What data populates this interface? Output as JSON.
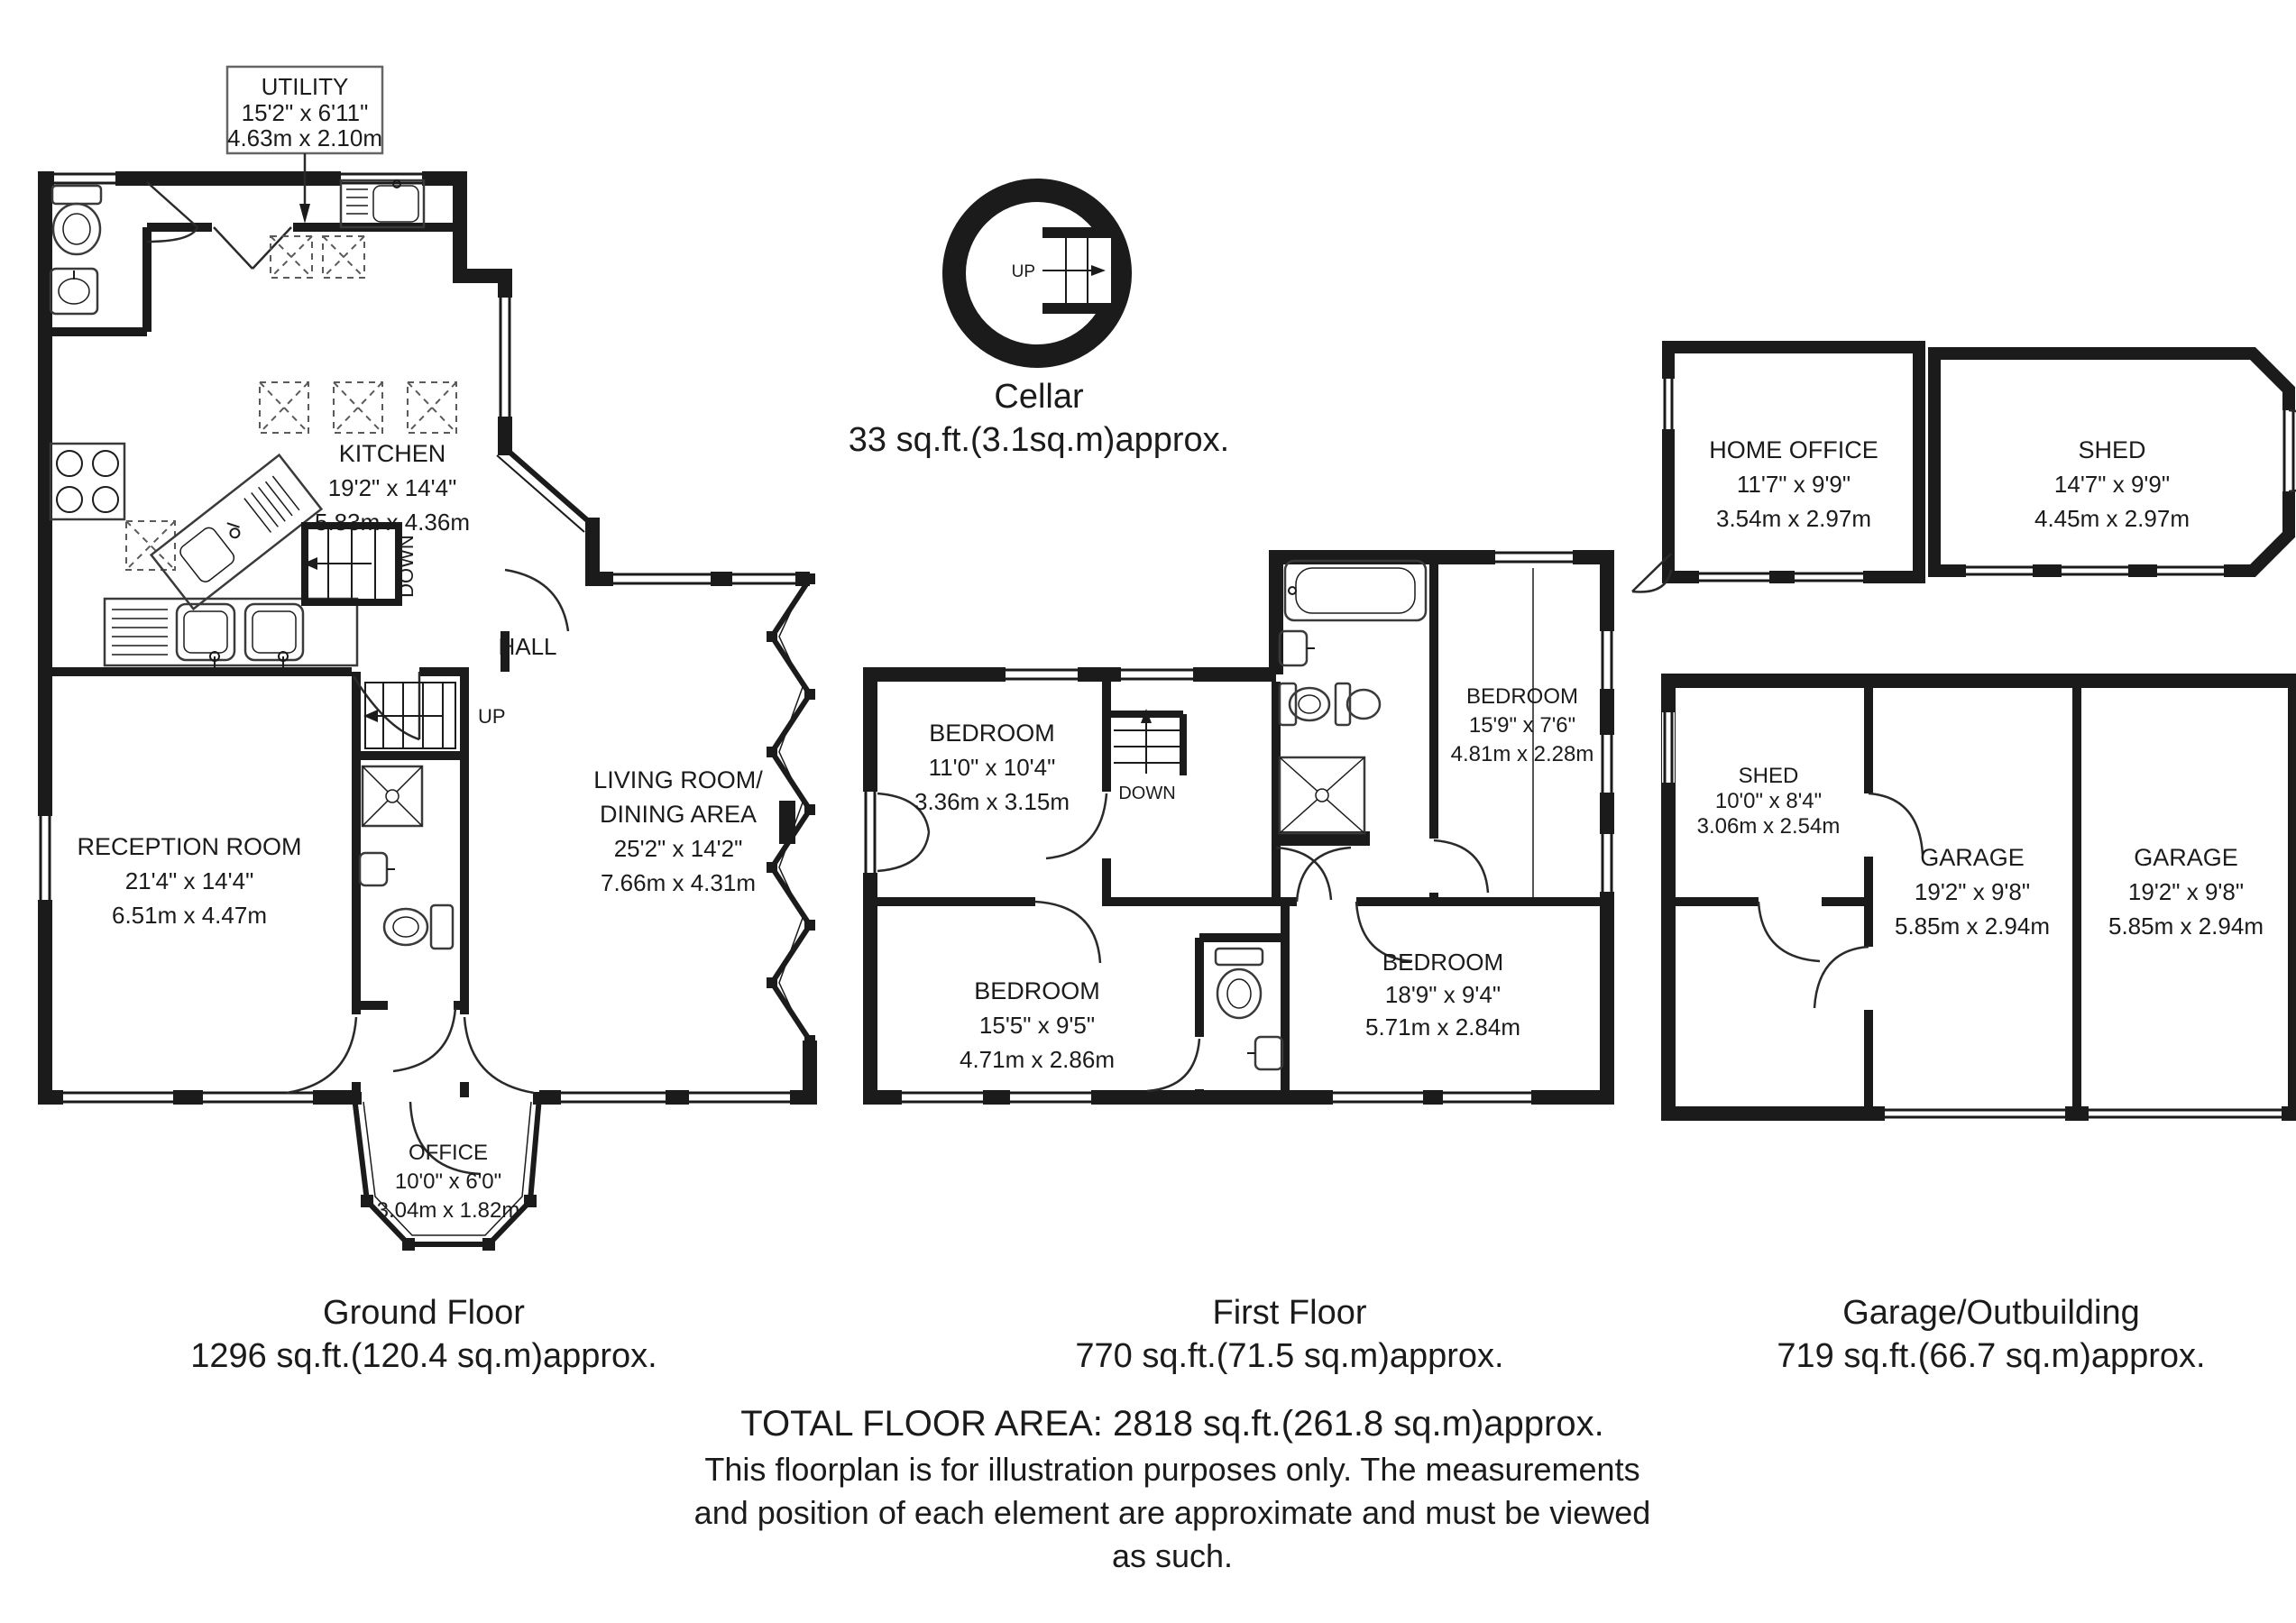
{
  "palette": {
    "ink": "#1b1b1b",
    "bg": "#ffffff"
  },
  "ground_floor": {
    "title": "Ground Floor",
    "area": "1296 sq.ft.(120.4 sq.m)approx.",
    "utility": {
      "name": "UTILITY",
      "imperial": "15'2\" x 6'11\"",
      "metric": "4.63m x 2.10m"
    },
    "kitchen": {
      "name": "KITCHEN",
      "imperial": "19'2\" x 14'4\"",
      "metric": "5.83m x 4.36m"
    },
    "hall": {
      "name": "HALL"
    },
    "living_room": {
      "name1": "LIVING ROOM/",
      "name2": "DINING AREA",
      "imperial": "25'2\" x 14'2\"",
      "metric": "7.66m x 4.31m"
    },
    "reception": {
      "name": "RECEPTION ROOM",
      "imperial": "21'4\" x 14'4\"",
      "metric": "6.51m x 4.47m"
    },
    "office": {
      "name": "OFFICE",
      "imperial": "10'0\" x 6'0\"",
      "metric": "3.04m x 1.82m"
    },
    "stair_up": "UP",
    "stair_down": "DOWN"
  },
  "cellar": {
    "title": "Cellar",
    "area": "33 sq.ft.(3.1sq.m)approx.",
    "stair_up": "UP"
  },
  "first_floor": {
    "title": "First Floor",
    "area": "770 sq.ft.(71.5 sq.m)approx.",
    "bedroom_nw": {
      "name": "BEDROOM",
      "imperial": "11'0\" x 10'4\"",
      "metric": "3.36m x 3.15m"
    },
    "bedroom_ne": {
      "name": "BEDROOM",
      "imperial": "15'9\" x 7'6\"",
      "metric": "4.81m x 2.28m"
    },
    "bedroom_sw": {
      "name": "BEDROOM",
      "imperial": "15'5\" x 9'5\"",
      "metric": "4.71m x 2.86m"
    },
    "bedroom_se": {
      "name": "BEDROOM",
      "imperial": "18'9\" x 9'4\"",
      "metric": "5.71m x 2.84m"
    },
    "stair_down": "DOWN"
  },
  "outbuilding": {
    "title": "Garage/Outbuilding",
    "area": "719 sq.ft.(66.7 sq.m)approx.",
    "home_office": {
      "name": "HOME OFFICE",
      "imperial": "11'7\" x 9'9\"",
      "metric": "3.54m x 2.97m"
    },
    "shed_large": {
      "name": "SHED",
      "imperial": "14'7\" x 9'9\"",
      "metric": "4.45m x 2.97m"
    },
    "shed_small": {
      "name": "SHED",
      "imperial": "10'0\" x 8'4\"",
      "metric": "3.06m x 2.54m"
    },
    "garage_west": {
      "name": "GARAGE",
      "imperial": "19'2\" x 9'8\"",
      "metric": "5.85m x 2.94m"
    },
    "garage_east": {
      "name": "GARAGE",
      "imperial": "19'2\" x 9'8\"",
      "metric": "5.85m x 2.94m"
    }
  },
  "footer": {
    "total": "TOTAL FLOOR AREA: 2818 sq.ft.(261.8 sq.m)approx.",
    "disclaimer1": "This floorplan is for illustration purposes only. The measurements",
    "disclaimer2": "and position of each element are approximate and must be viewed",
    "disclaimer3": "as such."
  }
}
